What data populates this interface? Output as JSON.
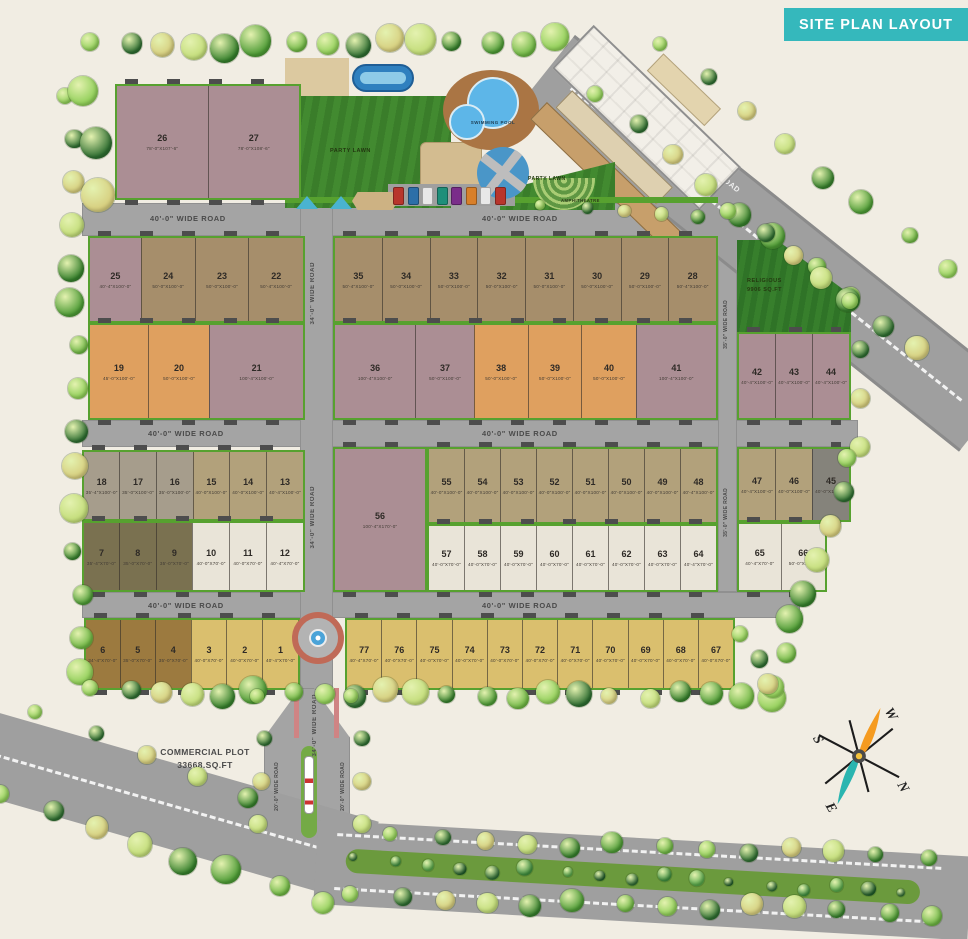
{
  "title": "SITE PLAN LAYOUT",
  "roads": {
    "r40": "40'-0\" WIDE ROAD",
    "r34": "34'-0\" WIDE ROAD",
    "r35": "35'-0\" WIDE ROAD",
    "r20": "20'-0\" WIDE ROAD",
    "r80": "80'-0\" WIDE ROAD"
  },
  "amenities": {
    "party_lawn_1": "PARTY LAWN",
    "swimming_pool": "SWIMMING POOL",
    "party_lawn_2": "PARTY LAWN",
    "amphitheatre": "AMPHITHEATRE",
    "religious_line1": "RELIGIOUS",
    "religious_line2": "9906 SQ.FT"
  },
  "commercial": {
    "line1": "COMMERCIAL PLOT",
    "line2": "33668.SQ.FT"
  },
  "compass": {
    "n": "N",
    "s": "S",
    "e": "E",
    "w": "W"
  },
  "palette": {
    "mauve": "#ab8e94",
    "tan": "#a68e6b",
    "orange": "#dfa05f",
    "khaki": "#b2a17b",
    "graytan": "#a69d8c",
    "olive": "#7a7150",
    "cream": "#e9e4d8",
    "yellow": "#dabf6e",
    "brown": "#9c7a3f",
    "darkgray": "#85837b",
    "road_gray": "#a4a4a4",
    "verge_green": "#57a12f",
    "lawn_green": "#3e8230",
    "banner_teal": "#35b8bc",
    "pool_blue": "#5db6e8"
  },
  "blocks": {
    "b26": {
      "plots": [
        {
          "n": "26",
          "d": "78'-0\"X107'-6\"",
          "c": "mauve"
        },
        {
          "n": "27",
          "d": "78'-0\"X108'-6\"",
          "c": "mauve"
        }
      ]
    },
    "a1": {
      "plots": [
        {
          "n": "25",
          "d": "40'-4\"X100'-0\"",
          "c": "mauve"
        },
        {
          "n": "24",
          "d": "50'-0\"X100'-0\"",
          "c": "tan"
        },
        {
          "n": "23",
          "d": "50'-0\"X100'-0\"",
          "c": "tan"
        },
        {
          "n": "22",
          "d": "50'-4\"X100'-0\"",
          "c": "tan"
        }
      ]
    },
    "a2": {
      "plots": [
        {
          "n": "19",
          "d": "45'-0\"X100'-0\"",
          "c": "orange"
        },
        {
          "n": "20",
          "d": "50'-0\"X100'-0\"",
          "c": "orange"
        },
        {
          "n": "21",
          "d": "100'-4\"X100'-0\"",
          "c": "mauve"
        }
      ]
    },
    "b1": {
      "plots": [
        {
          "n": "35",
          "d": "50'-4\"X100'-0\"",
          "c": "tan"
        },
        {
          "n": "34",
          "d": "50'-0\"X100'-0\"",
          "c": "tan"
        },
        {
          "n": "33",
          "d": "50'-0\"X100'-0\"",
          "c": "tan"
        },
        {
          "n": "32",
          "d": "50'-0\"X100'-0\"",
          "c": "tan"
        },
        {
          "n": "31",
          "d": "50'-0\"X100'-0\"",
          "c": "tan"
        },
        {
          "n": "30",
          "d": "50'-0\"X100'-0\"",
          "c": "tan"
        },
        {
          "n": "29",
          "d": "50'-0\"X100'-0\"",
          "c": "tan"
        },
        {
          "n": "28",
          "d": "50'-4\"X100'-0\"",
          "c": "tan"
        }
      ]
    },
    "b2": {
      "plots": [
        {
          "n": "36",
          "d": "100'-4\"X100'-0\"",
          "c": "mauve"
        },
        {
          "n": "37",
          "d": "50'-0\"X100'-0\"",
          "c": "mauve"
        },
        {
          "n": "38",
          "d": "50'-0\"X100'-0\"",
          "c": "orange"
        },
        {
          "n": "39",
          "d": "50'-0\"X100'-0\"",
          "c": "orange"
        },
        {
          "n": "40",
          "d": "50'-0\"X100'-0\"",
          "c": "orange"
        },
        {
          "n": "41",
          "d": "100'-4\"X100'-0\"",
          "c": "mauve"
        }
      ]
    },
    "r1": {
      "plots": [
        {
          "n": "42",
          "d": "40'-4\"X100'-0\"",
          "c": "mauve"
        },
        {
          "n": "43",
          "d": "40'-4\"X100'-0\"",
          "c": "mauve"
        },
        {
          "n": "44",
          "d": "40'-4\"X100'-0\"",
          "c": "mauve"
        }
      ]
    },
    "c1": {
      "plots": [
        {
          "n": "18",
          "d": "35'-4\"X100'-0\"",
          "c": "graytan"
        },
        {
          "n": "17",
          "d": "35'-0\"X100'-0\"",
          "c": "graytan"
        },
        {
          "n": "16",
          "d": "35'-0\"X100'-0\"",
          "c": "graytan"
        },
        {
          "n": "15",
          "d": "40'-0\"X100'-0\"",
          "c": "khaki"
        },
        {
          "n": "14",
          "d": "40'-0\"X100'-0\"",
          "c": "khaki"
        },
        {
          "n": "13",
          "d": "40'-4\"X100'-0\"",
          "c": "khaki"
        }
      ]
    },
    "c2": {
      "plots": [
        {
          "n": "7",
          "d": "35'-4\"X70'-0\"",
          "c": "olive"
        },
        {
          "n": "8",
          "d": "35'-0\"X70'-0\"",
          "c": "olive"
        },
        {
          "n": "9",
          "d": "35'-0\"X70'-0\"",
          "c": "olive"
        },
        {
          "n": "10",
          "d": "40'-0\"X70'-0\"",
          "c": "cream"
        },
        {
          "n": "11",
          "d": "40'-0\"X70'-0\"",
          "c": "cream"
        },
        {
          "n": "12",
          "d": "40'-4\"X70'-0\"",
          "c": "cream"
        }
      ]
    },
    "d56": {
      "plots": [
        {
          "n": "56",
          "d": "100'-4\"X170'-0\"",
          "c": "mauve"
        }
      ]
    },
    "d1": {
      "plots": [
        {
          "n": "55",
          "d": "40'-0\"X100'-0\"",
          "c": "khaki"
        },
        {
          "n": "54",
          "d": "40'-0\"X100'-0\"",
          "c": "khaki"
        },
        {
          "n": "53",
          "d": "40'-0\"X100'-0\"",
          "c": "khaki"
        },
        {
          "n": "52",
          "d": "40'-0\"X100'-0\"",
          "c": "khaki"
        },
        {
          "n": "51",
          "d": "40'-0\"X100'-0\"",
          "c": "khaki"
        },
        {
          "n": "50",
          "d": "40'-0\"X100'-0\"",
          "c": "khaki"
        },
        {
          "n": "49",
          "d": "40'-0\"X100'-0\"",
          "c": "khaki"
        },
        {
          "n": "48",
          "d": "40'-4\"X100'-0\"",
          "c": "khaki"
        }
      ]
    },
    "d2": {
      "plots": [
        {
          "n": "57",
          "d": "40'-0\"X70'-0\"",
          "c": "cream"
        },
        {
          "n": "58",
          "d": "40'-0\"X70'-0\"",
          "c": "cream"
        },
        {
          "n": "59",
          "d": "40'-0\"X70'-0\"",
          "c": "cream"
        },
        {
          "n": "60",
          "d": "40'-0\"X70'-0\"",
          "c": "cream"
        },
        {
          "n": "61",
          "d": "40'-0\"X70'-0\"",
          "c": "cream"
        },
        {
          "n": "62",
          "d": "40'-0\"X70'-0\"",
          "c": "cream"
        },
        {
          "n": "63",
          "d": "40'-0\"X70'-0\"",
          "c": "cream"
        },
        {
          "n": "64",
          "d": "40'-4\"X70'-0\"",
          "c": "cream"
        }
      ]
    },
    "r2": {
      "plots": [
        {
          "n": "47",
          "d": "40'-4\"X100'-0\"",
          "c": "khaki"
        },
        {
          "n": "46",
          "d": "40'-0\"X100'-0\"",
          "c": "khaki"
        },
        {
          "n": "45",
          "d": "40'-0\"X100'-0\"",
          "c": "darkgray"
        }
      ]
    },
    "r3": {
      "plots": [
        {
          "n": "65",
          "d": "40'-4\"X70'-0\"",
          "c": "cream"
        },
        {
          "n": "66",
          "d": "50'-0\"X70'-0\"",
          "c": "cream"
        }
      ]
    },
    "e1": {
      "plots": [
        {
          "n": "6",
          "d": "34'-4\"X70'-0\"",
          "c": "brown"
        },
        {
          "n": "5",
          "d": "35'-0\"X70'-0\"",
          "c": "brown"
        },
        {
          "n": "4",
          "d": "35'-0\"X70'-0\"",
          "c": "brown"
        },
        {
          "n": "3",
          "d": "40'-0\"X70'-0\"",
          "c": "yellow"
        },
        {
          "n": "2",
          "d": "40'-0\"X70'-0\"",
          "c": "yellow"
        },
        {
          "n": "1",
          "d": "40'-4\"X70'-0\"",
          "c": "yellow"
        }
      ]
    },
    "e2": {
      "plots": [
        {
          "n": "77",
          "d": "40'-4\"X70'-0\"",
          "c": "yellow"
        },
        {
          "n": "76",
          "d": "40'-0\"X70'-0\"",
          "c": "yellow"
        },
        {
          "n": "75",
          "d": "40'-0\"X70'-0\"",
          "c": "yellow"
        },
        {
          "n": "74",
          "d": "40'-0\"X70'-0\"",
          "c": "yellow"
        },
        {
          "n": "73",
          "d": "40'-0\"X70'-0\"",
          "c": "yellow"
        },
        {
          "n": "72",
          "d": "40'-0\"X70'-0\"",
          "c": "yellow"
        },
        {
          "n": "71",
          "d": "40'-0\"X70'-0\"",
          "c": "yellow"
        },
        {
          "n": "70",
          "d": "40'-0\"X70'-0\"",
          "c": "yellow"
        },
        {
          "n": "69",
          "d": "40'-0\"X70'-0\"",
          "c": "yellow"
        },
        {
          "n": "68",
          "d": "40'-0\"X70'-0\"",
          "c": "yellow"
        },
        {
          "n": "67",
          "d": "40'-0\"X70'-0\"",
          "c": "yellow"
        }
      ]
    }
  }
}
